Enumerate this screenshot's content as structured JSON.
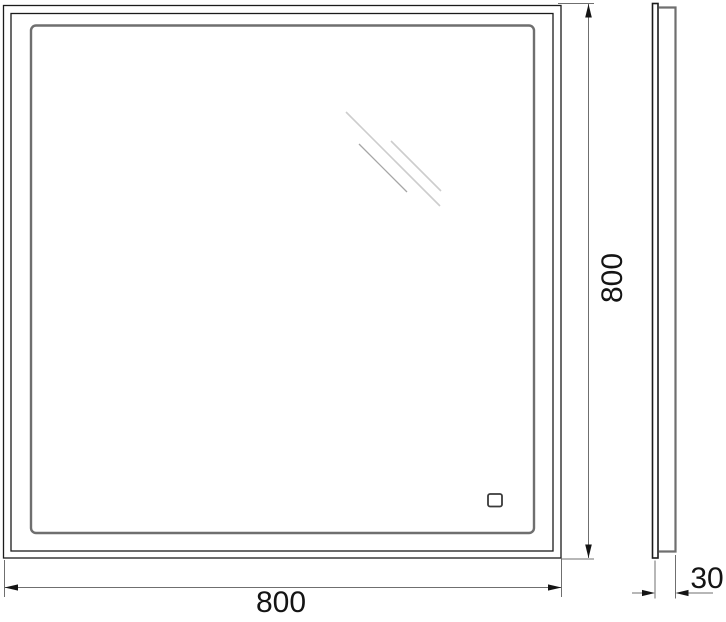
{
  "drawing": {
    "kind": "mirror-dimension-drawing",
    "views": {
      "front": "front-view",
      "side": "side-profile-view"
    }
  },
  "dimensions": {
    "width": {
      "label": "800"
    },
    "height": {
      "label": "800"
    },
    "depth": {
      "label": "30"
    }
  },
  "colors": {
    "background": "#ffffff",
    "outline": "#1b1b1b",
    "inner_frame": "#6f6f6f",
    "dimension_line": "#6f6f6f",
    "arrow_and_text": "#141414",
    "glare": "#cdcdcd",
    "glare_dark": "#a6a6a6",
    "sensor_outline": "#3a3a3a"
  }
}
